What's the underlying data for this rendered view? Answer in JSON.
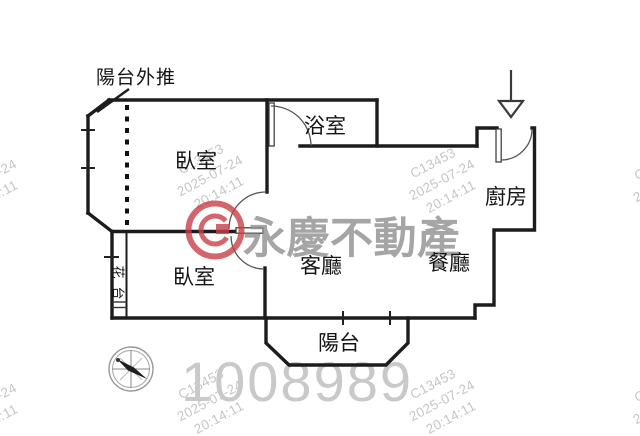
{
  "floorplan": {
    "annotation_balcony_pushout": "陽台外推",
    "rooms": {
      "bedroom_upper": "臥室",
      "bathroom": "浴室",
      "kitchen": "廚房",
      "bedroom_lower": "臥室",
      "living_room": "客廳",
      "dining_room": "餐廳",
      "balcony": "陽台",
      "flower_stand": "花台",
      "flower_stand_chars": [
        "花",
        "台"
      ]
    },
    "icons": {
      "entrance_arrow": "down-arrow entrance marker",
      "compass": "compass rose"
    }
  },
  "watermark": {
    "logo_text": "永慶不動產",
    "listing_number": "1008989",
    "stamp_lines": [
      "C13453",
      "2025-07-24",
      "20:14:11"
    ],
    "colors": {
      "logo_red": "#c84048",
      "logo_gray": "#8f8f8f",
      "stamp_gray": "#c2c2c2",
      "number_gray": "#c9c9c9",
      "wall_black": "#1c1c1c"
    }
  }
}
